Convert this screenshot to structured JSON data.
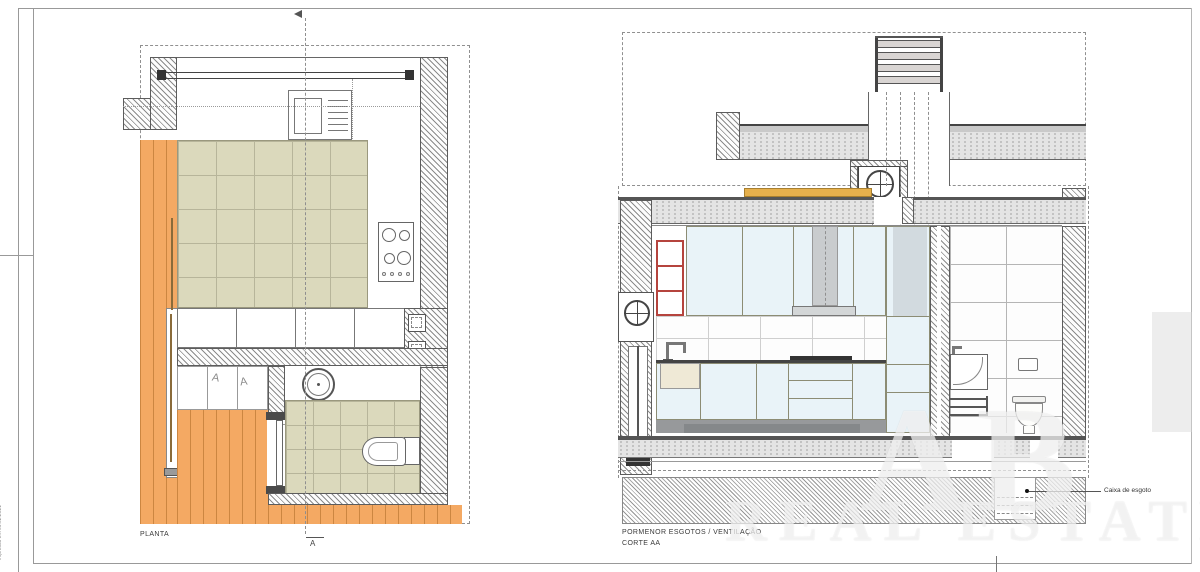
{
  "sheet": {
    "stamp_vertical": "impresso em 06.02.2021"
  },
  "plan": {
    "title": "PLANTA",
    "section_marker_bottom": "A"
  },
  "section": {
    "title_line1": "PORMENOR ESGOTOS / VENTILAÇÃO",
    "title_line2": "CORTE AA",
    "annotation_caixa": "Caixa de esgoto"
  },
  "wardrobe": {
    "hanger_mark_1": "A",
    "hanger_mark_2": "A"
  },
  "watermark": {
    "line1": "AB",
    "line2": "REAL ESTATE"
  },
  "colors": {
    "deck_orange": "#F4A963",
    "tile_beige": "#DBD9BC",
    "cabinet_blue": "#E9F3F8",
    "cabinet_frame_olive": "#8C8C74",
    "shelf_red": "#B5443E",
    "blocking_orange": "#E6B04C",
    "line_grey": "#5C5C5C"
  }
}
